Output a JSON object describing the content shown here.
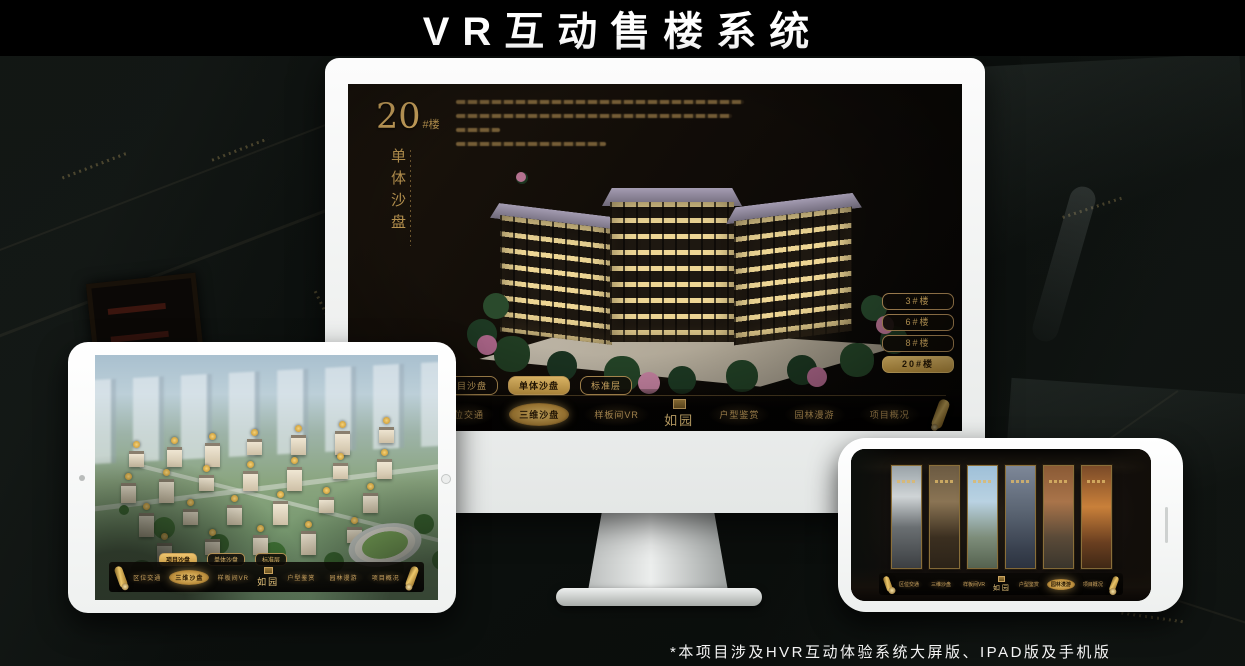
{
  "page": {
    "title": "VR互动售楼系统",
    "footnote": "*本项目涉及HVR互动体验系统大屏版、IPAD版及手机版"
  },
  "logo": {
    "name": "如园"
  },
  "tabs": [
    "项目沙盘",
    "单体沙盘",
    "标准层"
  ],
  "nav_labels": [
    "区位交通",
    "三维沙盘",
    "样板间VR",
    "户型鉴赏",
    "园林漫游",
    "项目概况"
  ],
  "monitor_app": {
    "heading": {
      "number": "20",
      "suffix": "#楼",
      "subtitle": "单体沙盘"
    },
    "building_buttons": [
      {
        "label": "3#楼",
        "selected": false
      },
      {
        "label": "6#楼",
        "selected": false
      },
      {
        "label": "8#楼",
        "selected": false
      },
      {
        "label": "20#楼",
        "selected": true
      }
    ],
    "selected_tab_index": 1,
    "selected_nav_index": 1
  },
  "ipad_app": {
    "selected_tab_index": 0,
    "selected_nav_index": 1
  },
  "phone_app": {
    "selected_nav_index": 4
  },
  "colors": {
    "gold": "#c9a25e",
    "gold_bright": "#ecc66f",
    "selected_text": "#2a1a05"
  }
}
